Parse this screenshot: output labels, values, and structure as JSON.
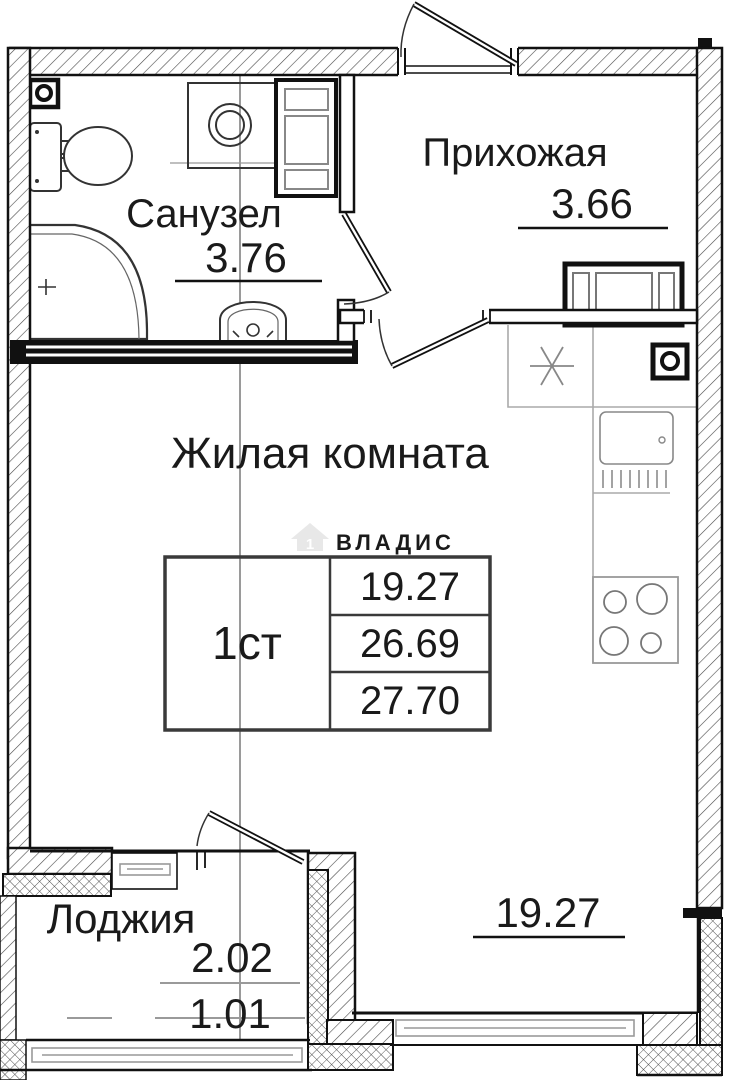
{
  "plan": {
    "rooms": {
      "bathroom": {
        "name": "Санузел",
        "area": "3.76"
      },
      "hallway": {
        "name": "Прихожая",
        "area": "3.66"
      },
      "living": {
        "name": "Жилая комната",
        "area": "19.27"
      },
      "loggia": {
        "name": "Лоджия",
        "area": "2.02",
        "area_reduced": "1.01"
      }
    },
    "unit_table": {
      "type": "1ст",
      "living_area": "19.27",
      "area_main": "26.69",
      "area_total": "27.70"
    },
    "watermark": {
      "brand": "ВЛАДИС",
      "house_number": "1"
    },
    "colors": {
      "wall": "#111111",
      "fixture": "#333333",
      "grid_line": "#9a9a9a",
      "counter": "#aaaaaa",
      "watermark": "#e8e8e8"
    }
  }
}
